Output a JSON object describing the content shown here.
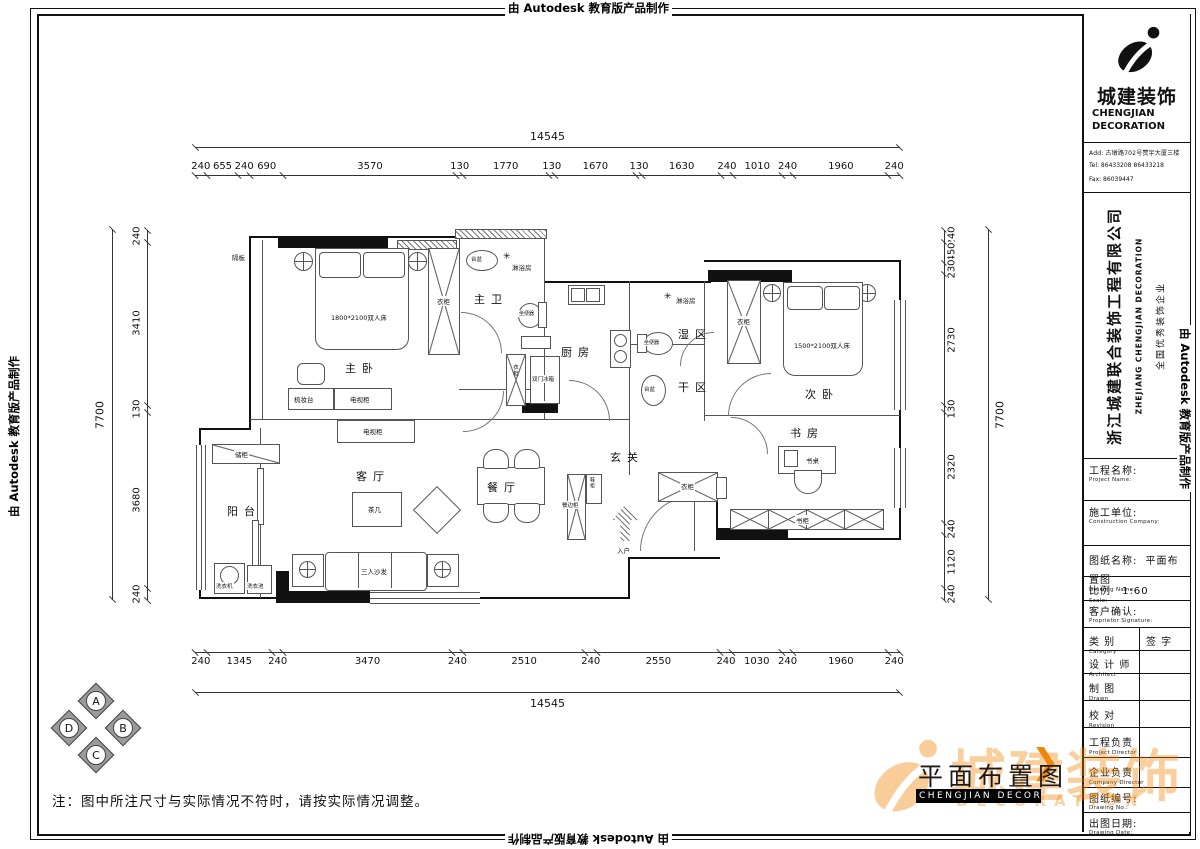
{
  "stamps": {
    "autodesk": "由 Autodesk 教育版产品制作"
  },
  "icons": {
    "shower": "✳",
    "chevron": "❯"
  },
  "dims": {
    "total_h": "14545",
    "total_v": "7700",
    "top": [
      240,
      655,
      240,
      690,
      3570,
      130,
      1770,
      130,
      1670,
      130,
      1630,
      240,
      1010,
      240,
      1960,
      240
    ],
    "bottom": [
      240,
      1345,
      240,
      3470,
      240,
      2510,
      240,
      2550,
      240,
      1030,
      240,
      1960,
      240
    ],
    "left": [
      240,
      3410,
      130,
      3680,
      240
    ],
    "right": [
      240,
      450,
      230,
      2730,
      130,
      2320,
      240,
      1120,
      240
    ]
  },
  "plan": {
    "rooms": {
      "master": "主卧",
      "master_bath": "主卫",
      "shower": "淋浴房",
      "kitchen": "厨房",
      "wet": "湿区",
      "dry": "干区",
      "second": "次卧",
      "study": "书房",
      "living": "客厅",
      "dining": "餐厅",
      "foyer": "玄关",
      "balcony": "阳台"
    },
    "furniture": {
      "bed_master": "1800*2100双人床",
      "bed_second": "1500*2100双人床",
      "wardrobe": "衣柜",
      "dresser": "梳妆台",
      "tv_cabinet": "电视柜",
      "tea_table": "茶几",
      "sofa": "三人沙发",
      "sideboard": "餐边柜",
      "shoe": "鞋柜",
      "desk": "书桌",
      "bookcase": "书柜",
      "fridge": "双门冰箱",
      "toilet": "坐便器",
      "basin": "台盆",
      "washer": "洗衣机",
      "laundry": "洗衣池",
      "storage": "储柜",
      "shelf": "隔板",
      "entry": "入户"
    }
  },
  "compass": {
    "n": "A",
    "e": "B",
    "s": "C",
    "w": "D"
  },
  "note": "注：图中所注尺寸与实际情况不符时，请按实际情况调整。",
  "footer": {
    "title": "平面布置图",
    "band": "CHENGJIAN DECORATION"
  },
  "watermark": {
    "cn": "城建装饰",
    "en": "DECORATION"
  },
  "title_block": {
    "brand_cn": "城建装饰",
    "brand_en1": "CHENGJIAN",
    "brand_en2": "DECORATION",
    "add": "Add:  古墩路702号赞宇大厦三楼",
    "tel": "Tel:  86433208  86433218",
    "fax": "Fax:  86039447",
    "company_cn": "浙江城建联合装饰工程有限公司",
    "company_en": "ZHEJIANG CHENGJIAN DECORATION",
    "slogan": "全国优秀装饰企业",
    "rows": [
      {
        "cn": "工程名称:",
        "en": "Project Name:",
        "val": ""
      },
      {
        "cn": "施工单位:",
        "en": "Construction Company:",
        "val": ""
      },
      {
        "cn": "图纸名称:",
        "en": "Drawing Name:",
        "val": "平面布置图"
      },
      {
        "cn": "比例",
        "en": "Scale:",
        "val": "1:60"
      },
      {
        "cn": "客户确认:",
        "en": "Proprietor Signature:",
        "val": ""
      },
      {
        "cn": "类 别",
        "en": "Category",
        "val": "签 字"
      },
      {
        "cn": "设 计 师",
        "en": "Architect",
        "val": ""
      },
      {
        "cn": "制 图",
        "en": "Drawn",
        "val": ""
      },
      {
        "cn": "校 对",
        "en": "Revision",
        "val": ""
      },
      {
        "cn": "工程负责",
        "en": "Project Director",
        "val": ""
      },
      {
        "cn": "企业负责",
        "en": "Company Director",
        "val": ""
      },
      {
        "cn": "图纸编号:",
        "en": "Drawing No.:",
        "val": ""
      },
      {
        "cn": "出图日期:",
        "en": "Drawing Date:",
        "val": ""
      }
    ]
  }
}
